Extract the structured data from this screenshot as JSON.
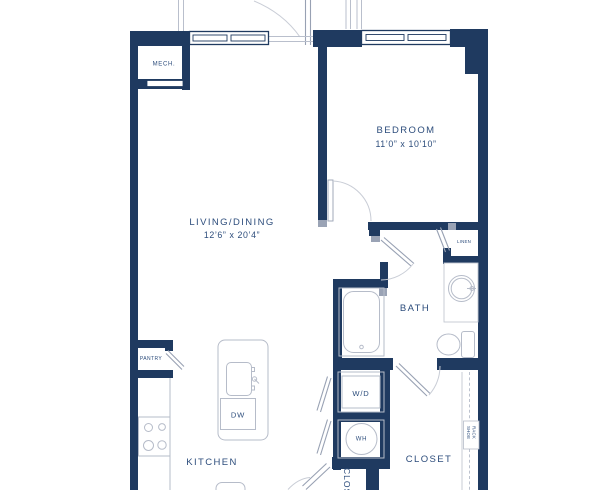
{
  "plan": {
    "type": "apartment-floor-plan",
    "colors": {
      "wall": "#1f3a60",
      "label": "#2d4d7c",
      "fixture_line": "#b6bcc9",
      "door_line": "#98a1b3",
      "background": "#ffffff"
    },
    "rooms": {
      "living": {
        "name": "LIVING/DINING",
        "dimensions": "12’6” x 20’4”"
      },
      "bedroom": {
        "name": "BEDROOM",
        "dimensions": "11’0” x 10’10”"
      },
      "kitchen": {
        "name": "KITCHEN"
      },
      "bath": {
        "name": "BATH"
      },
      "closet": {
        "name": "CLOSET"
      },
      "closet_vertical": {
        "name": "CLOSET"
      },
      "mech": {
        "name": "MECH."
      },
      "pantry": {
        "name": "PANTRY"
      },
      "linen": {
        "name": "LINEN"
      }
    },
    "fixtures": {
      "washer_dryer": "W/D",
      "water_heater": "WH",
      "dishwasher": "DW",
      "shoe_rack_line1": "SHOE",
      "shoe_rack_line2": "RACK"
    }
  }
}
